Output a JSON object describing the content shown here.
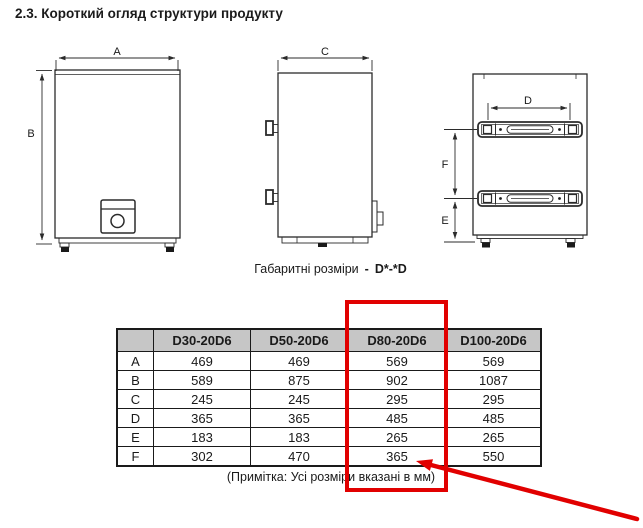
{
  "page": {
    "title": "2.3. Короткий огляд структури продукту",
    "caption": {
      "prefix": "Габаритні розміри",
      "separator": "-",
      "model_code": "D*-*D"
    },
    "note": "(Примітка: Усі розміри вказані в мм)"
  },
  "diagram": {
    "views": [
      "front-view",
      "side-view",
      "back-view"
    ],
    "dimension_labels": {
      "A": "A",
      "B": "B",
      "C": "C",
      "D": "D",
      "E": "E",
      "F": "F"
    }
  },
  "table": {
    "headers": [
      "",
      "D30-20D6",
      "D50-20D6",
      "D80-20D6",
      "D100-20D6"
    ],
    "rows": [
      {
        "label": "A",
        "values": [
          "469",
          "469",
          "569",
          "569"
        ]
      },
      {
        "label": "B",
        "values": [
          "589",
          "875",
          "902",
          "1087"
        ]
      },
      {
        "label": "C",
        "values": [
          "245",
          "245",
          "295",
          "295"
        ]
      },
      {
        "label": "D",
        "values": [
          "365",
          "365",
          "485",
          "485"
        ]
      },
      {
        "label": "E",
        "values": [
          "183",
          "183",
          "265",
          "265"
        ]
      },
      {
        "label": "F",
        "values": [
          "302",
          "470",
          "365",
          "550"
        ]
      }
    ]
  },
  "highlight": {
    "highlighted_column": "D80-20D6",
    "color": "#e10000"
  },
  "colors": {
    "table_header_bg": "#c6c6c6",
    "line": "#2b2b2b",
    "text": "#1a1a1a"
  }
}
